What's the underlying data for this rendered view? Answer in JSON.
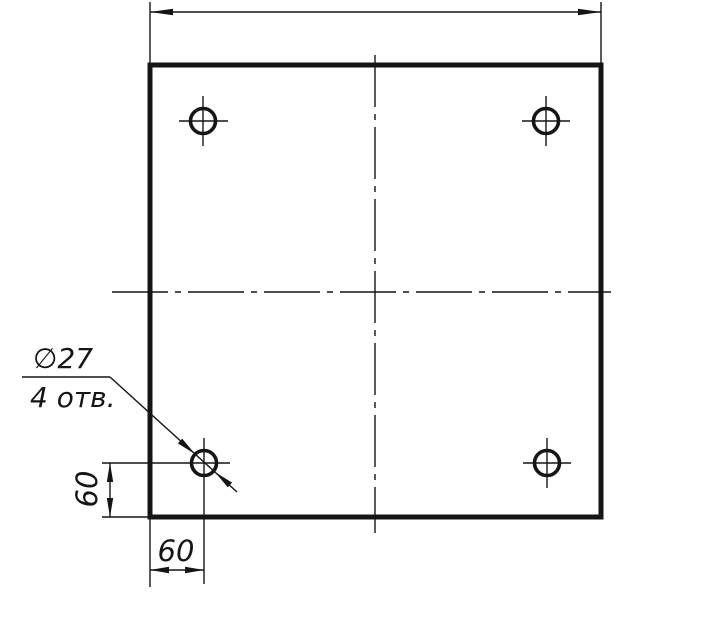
{
  "drawing": {
    "kind": "2D engineering drawing, GOST style, plan view",
    "subject": "Square plate with four drilled holes",
    "colors": {
      "line": "#151515",
      "background": "#ffffff"
    },
    "callout": {
      "diameter": "∅27",
      "holes_note": "4 отв."
    },
    "dimensions": {
      "vertical_offset": "60",
      "horizontal_offset": "60"
    }
  }
}
